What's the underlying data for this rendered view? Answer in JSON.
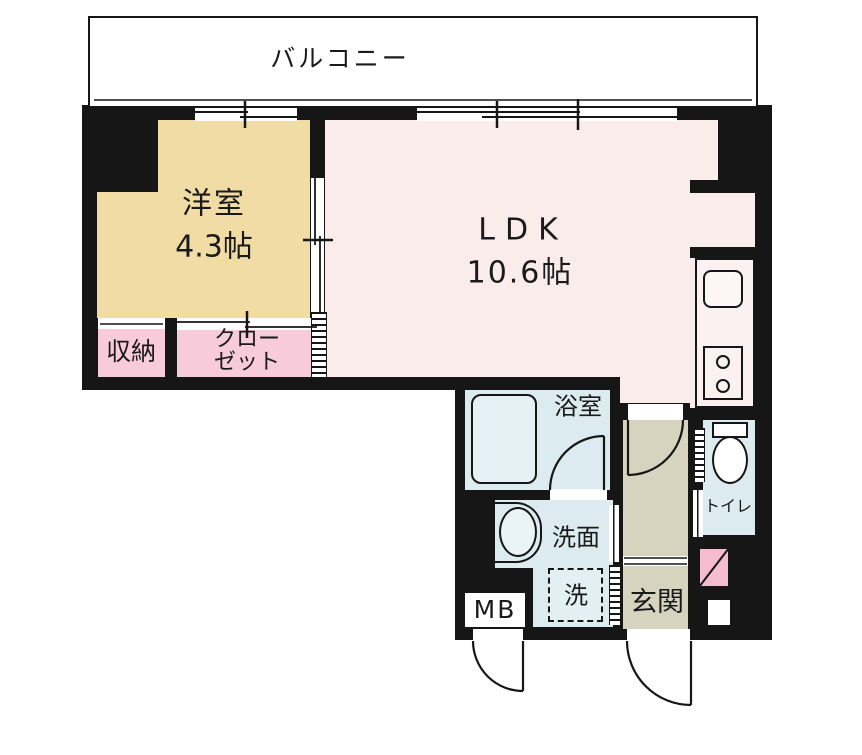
{
  "title": "1LDK apartment floor plan",
  "rooms": {
    "balcony": "バルコニー",
    "western_room": "洋室",
    "western_room_size": "4.3帖",
    "ldk": "LDK",
    "ldk_size": "10.6帖",
    "storage": "収納",
    "closet_line1": "クロー",
    "closet_line2": "ゼット",
    "bathroom": "浴室",
    "washroom": "洗面",
    "washing_machine": "洗",
    "meter_box": "MB",
    "entrance": "玄関",
    "toilet": "トイレ"
  },
  "colors": {
    "wall": "#161616",
    "western_room_floor": "#F2DCA6",
    "ldk_floor": "#FBECEC",
    "closet_floor": "#F7CBD9",
    "wet_area_floor": "#DCEBF0",
    "hall_floor": "#D6D3BE",
    "shoe_box": "#F5BCD0",
    "outline_white": "#FFFFFF"
  }
}
